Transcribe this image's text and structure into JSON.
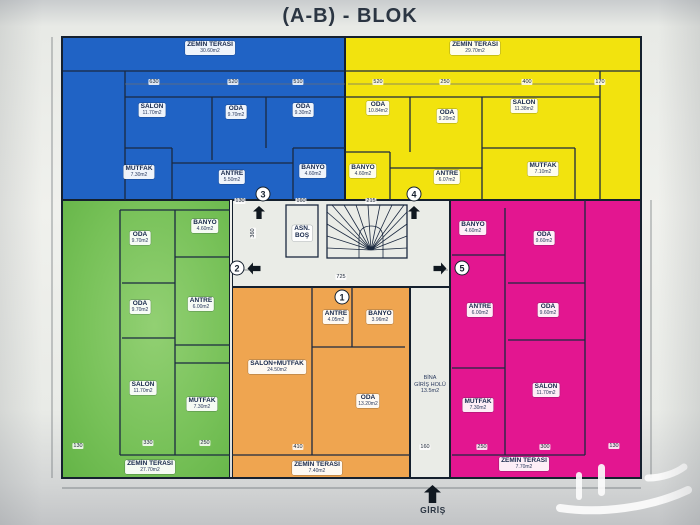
{
  "title": "(A-B) - BLOK",
  "entrance": {
    "label": "GİRİŞ"
  },
  "corridor": {
    "elevator_line1": "ASN.",
    "elevator_line2": "BOŞ",
    "hall_line1": "BİNA",
    "hall_line2": "GİRİŞ HOLÜ",
    "hall_area": "13.5m2"
  },
  "colors": {
    "unit1_orange": "#efa550",
    "unit2_green": "#77c158",
    "unit3_blue": "#2063c5",
    "unit4_yellow": "#f2e30e",
    "unit5_magenta": "#e31690",
    "wall": "#1c2430",
    "paper": "#eceee9"
  },
  "units": {
    "orange_1": {
      "number": "1",
      "rooms": {
        "antre": {
          "label": "ANTRE",
          "area": "4.05m2"
        },
        "banyo": {
          "label": "BANYO",
          "area": "3.96m2"
        },
        "salon_mutfak": {
          "label": "SALON+MUTFAK",
          "area": "24.50m2"
        },
        "oda": {
          "label": "ODA",
          "area": "13.20m2"
        },
        "teras": {
          "label": "ZEMİN TERASI",
          "area": "7.40m2"
        }
      }
    },
    "green_2": {
      "number": "2",
      "rooms": {
        "oda1": {
          "label": "ODA",
          "area": "9.70m2"
        },
        "banyo": {
          "label": "BANYO",
          "area": "4.60m2"
        },
        "oda2": {
          "label": "ODA",
          "area": "9.70m2"
        },
        "antre": {
          "label": "ANTRE",
          "area": "6.00m2"
        },
        "salon": {
          "label": "SALON",
          "area": "11.70m2"
        },
        "mutfak": {
          "label": "MUTFAK",
          "area": "7.30m2"
        },
        "teras": {
          "label": "ZEMİN TERASI",
          "area": "27.70m2"
        }
      }
    },
    "blue_3": {
      "number": "3",
      "rooms": {
        "teras": {
          "label": "ZEMİN TERASI",
          "area": "30.60m2"
        },
        "salon": {
          "label": "SALON",
          "area": "11.70m2"
        },
        "oda1": {
          "label": "ODA",
          "area": "9.70m2"
        },
        "oda2": {
          "label": "ODA",
          "area": "9.30m2"
        },
        "mutfak": {
          "label": "MUTFAK",
          "area": "7.30m2"
        },
        "antre": {
          "label": "ANTRE",
          "area": "5.50m2"
        },
        "banyo": {
          "label": "BANYO",
          "area": "4.60m2"
        }
      }
    },
    "yellow_4": {
      "number": "4",
      "rooms": {
        "teras": {
          "label": "ZEMİN TERASI",
          "area": "29.70m2"
        },
        "oda1": {
          "label": "ODA",
          "area": "10.84m2"
        },
        "oda2": {
          "label": "ODA",
          "area": "9.20m2"
        },
        "salon": {
          "label": "SALON",
          "area": "11.38m2"
        },
        "banyo": {
          "label": "BANYO",
          "area": "4.60m2"
        },
        "antre": {
          "label": "ANTRE",
          "area": "6.07m2"
        },
        "mutfak": {
          "label": "MUTFAK",
          "area": "7.10m2"
        }
      }
    },
    "magenta_5": {
      "number": "5",
      "rooms": {
        "banyo": {
          "label": "BANYO",
          "area": "4.60m2"
        },
        "oda1": {
          "label": "ODA",
          "area": "9.60m2"
        },
        "antre": {
          "label": "ANTRE",
          "area": "6.00m2"
        },
        "oda2": {
          "label": "ODA",
          "area": "9.60m2"
        },
        "mutfak": {
          "label": "MUTFAK",
          "area": "7.30m2"
        },
        "salon": {
          "label": "SALON",
          "area": "11.70m2"
        },
        "teras": {
          "label": "ZEMİN TERASI",
          "area": "7.70m2"
        }
      }
    }
  },
  "dims": {
    "d01": "725",
    "d02": "215",
    "d03": "160",
    "d04": "130",
    "d05": "360",
    "d06": "630",
    "d07": "520",
    "d08": "510",
    "d09": "520",
    "d10": "250",
    "d11": "400",
    "d12": "170",
    "d13": "130",
    "d14": "330",
    "d15": "250",
    "d16": "410",
    "d17": "160",
    "d18": "250",
    "d19": "300",
    "d20": "130"
  }
}
